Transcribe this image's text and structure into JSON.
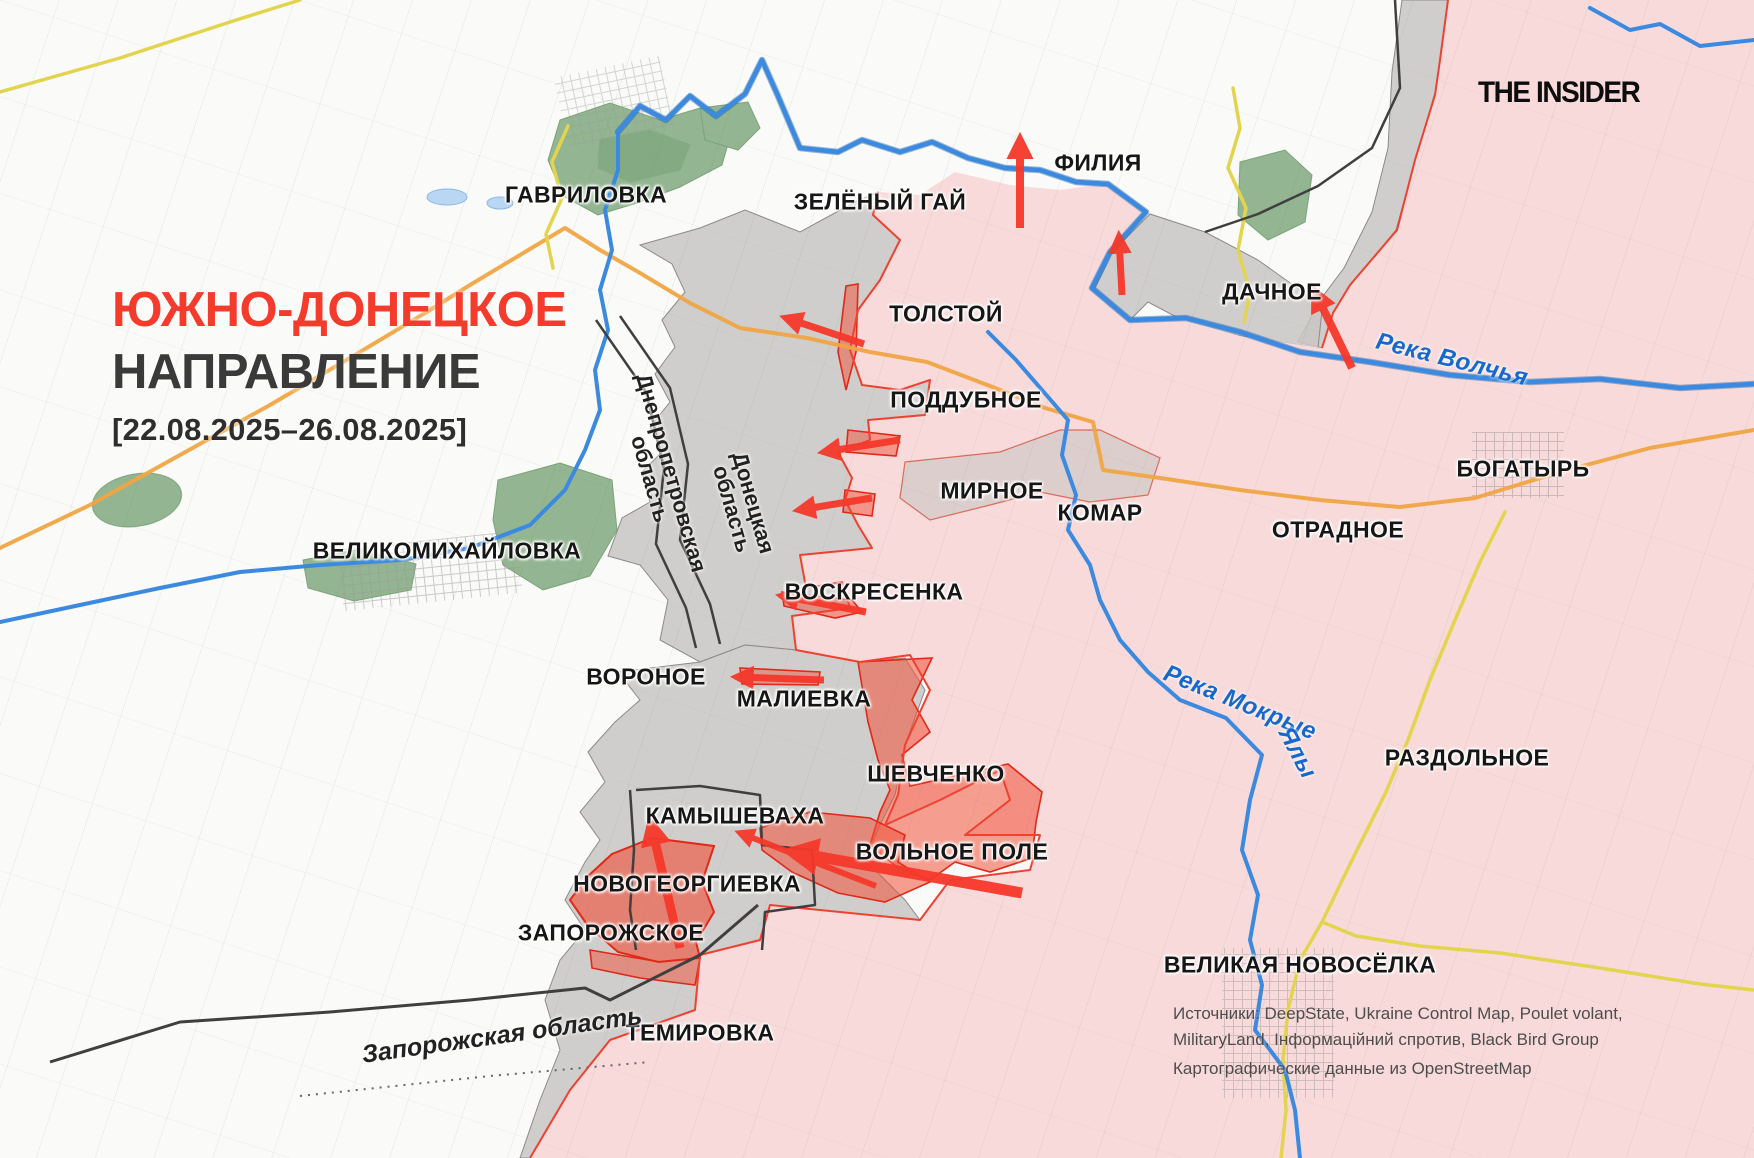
{
  "header": {
    "title_line1": "ЮЖНО-ДОНЕЦКОЕ",
    "title_line2": "НАПРАВЛЕНИЕ",
    "date_range": "[22.08.2025–26.08.2025]",
    "brand": "THE INSIDER"
  },
  "map": {
    "towns": [
      {
        "label": "ГАВРИЛОВКА"
      },
      {
        "label": "ЗЕЛЁНЫЙ ГАЙ"
      },
      {
        "label": "ФИЛИЯ"
      },
      {
        "label": "ТОЛСТОЙ"
      },
      {
        "label": "ДАЧНОЕ"
      },
      {
        "label": "ПОДДУБНОЕ"
      },
      {
        "label": "МИРНОЕ"
      },
      {
        "label": "КОМАР"
      },
      {
        "label": "ОТРАДНОЕ"
      },
      {
        "label": "БОГАТЫРЬ"
      },
      {
        "label": "ВЕЛИКОМИХАЙЛОВКА"
      },
      {
        "label": "ВОСКРЕСЕНКА"
      },
      {
        "label": "ВОРОНОЕ"
      },
      {
        "label": "МАЛИЕВКА"
      },
      {
        "label": "ШЕВЧЕНКО"
      },
      {
        "label": "КАМЫШЕВАХА"
      },
      {
        "label": "ВОЛЬНОЕ ПОЛЕ"
      },
      {
        "label": "НОВОГЕОРГИЕВКА"
      },
      {
        "label": "ЗАПОРОЖСКОЕ"
      },
      {
        "label": "ТЕМИРОВКА"
      },
      {
        "label": "РАЗДОЛЬНОЕ"
      },
      {
        "label": "ВЕЛИКАЯ НОВОСЁЛКА"
      }
    ],
    "regions": {
      "dnipro": {
        "line1": "Днепропетровская",
        "line2": "область"
      },
      "donetsk": {
        "line1": "Донецкая",
        "line2": "область"
      },
      "zaporizhzhia": {
        "label": "Запорожская область"
      }
    },
    "rivers": {
      "volchya": "Река Волчья",
      "mokrye": "Река Мокрые",
      "yaly": "Ялы"
    },
    "sources": {
      "line1": "Источники: DeepState, Ukraine Control Map, Poulet volant,",
      "line2": "MilitaryLand, Інформаційний спротив, Black Bird Group",
      "line3": "Картографические данные из OpenStreetMap"
    },
    "colors": {
      "accent_red": "#f5392c",
      "occupied_pink": "#f8dada",
      "contested_gray": "#c9c7c5",
      "advance_red": "#f05038",
      "river_blue": "#2e7fd8",
      "road_orange": "#f0a544",
      "road_yellow": "#e3d44f",
      "forest_green": "#87ad85"
    }
  }
}
